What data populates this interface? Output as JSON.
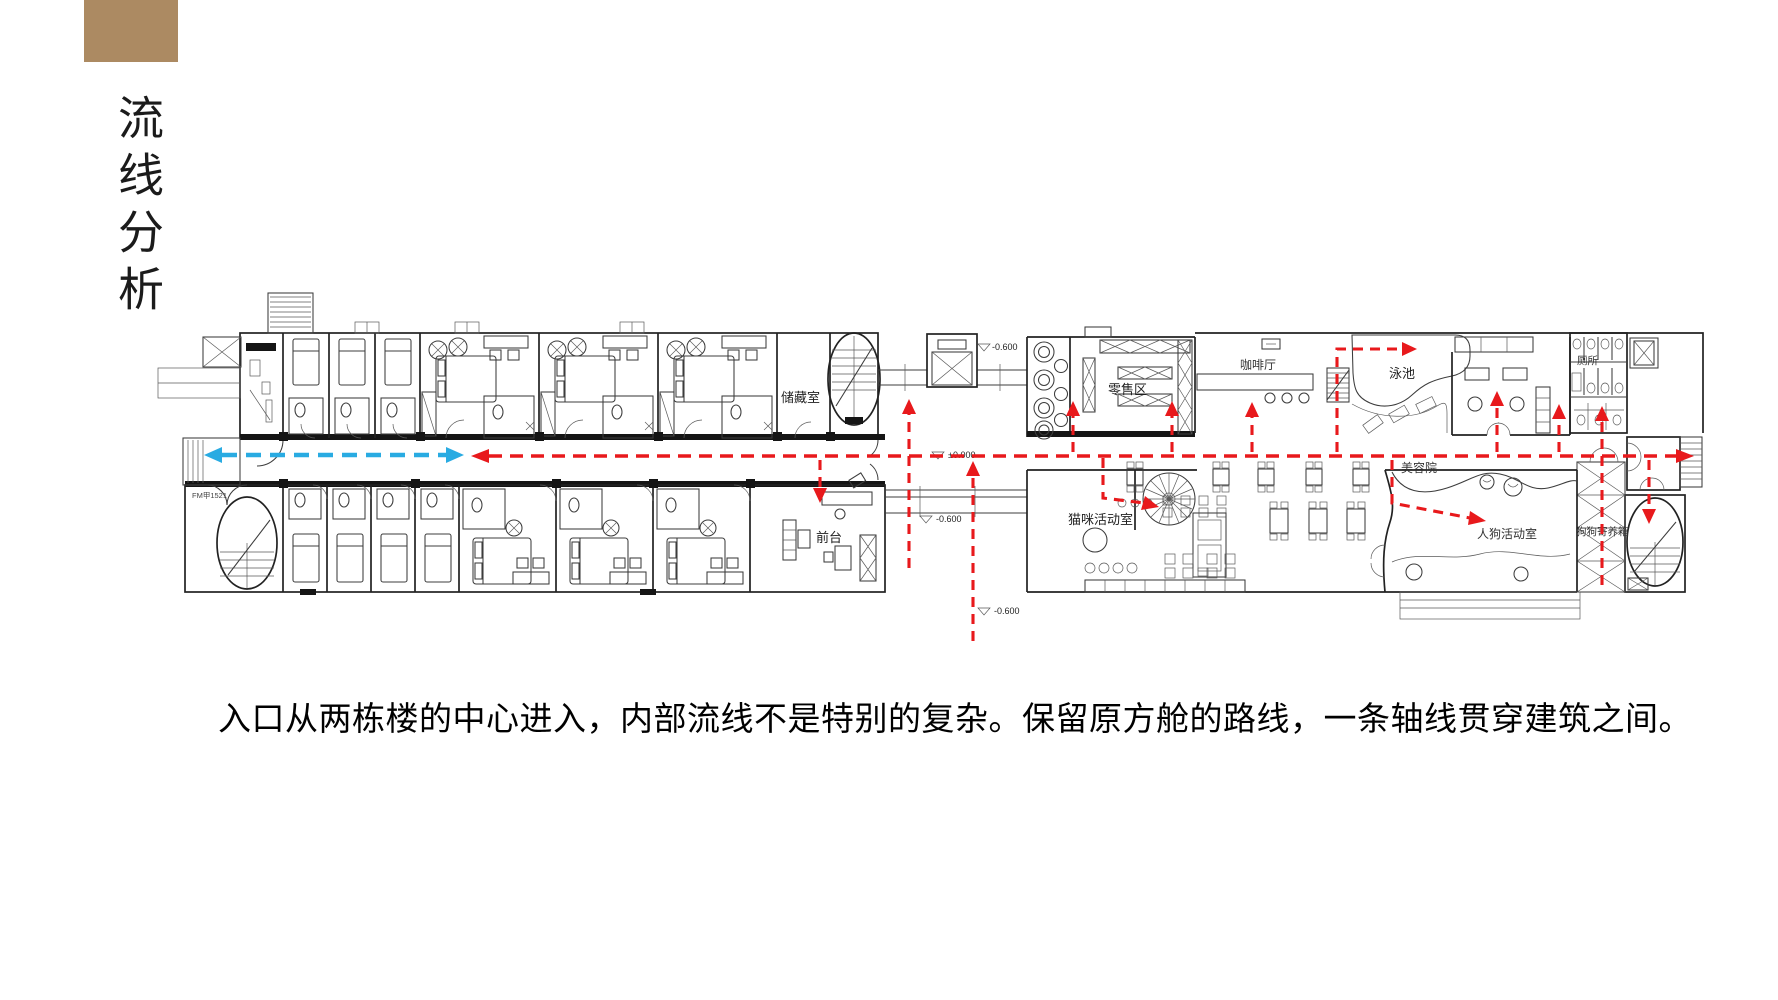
{
  "title": "流线分析",
  "caption": "入口从两栋楼的中心进入，内部流线不是特别的复杂。保留原方舱的路线，一条轴线贯穿建筑之间。",
  "plan": {
    "labels": {
      "storage": "储藏室",
      "front_desk": "前台",
      "retail": "零售区",
      "cafe": "咖啡厅",
      "pool": "泳池",
      "cat_room": "猫咪活动室",
      "beauty_salon": "美容院",
      "dog_room": "人狗活动室",
      "toilet": "厕所",
      "dog_boarding": "狗狗寄养箱",
      "fire_door": "FM甲1521"
    },
    "levels": {
      "top_bridge": "-0.600",
      "entrance": "±0.000",
      "south_bridge": "-0.600",
      "south_path": "-0.600"
    }
  },
  "colors": {
    "flow-red": "#e8191c",
    "flow-blue": "#29abe2",
    "accent-brown": "#ac8a62"
  }
}
